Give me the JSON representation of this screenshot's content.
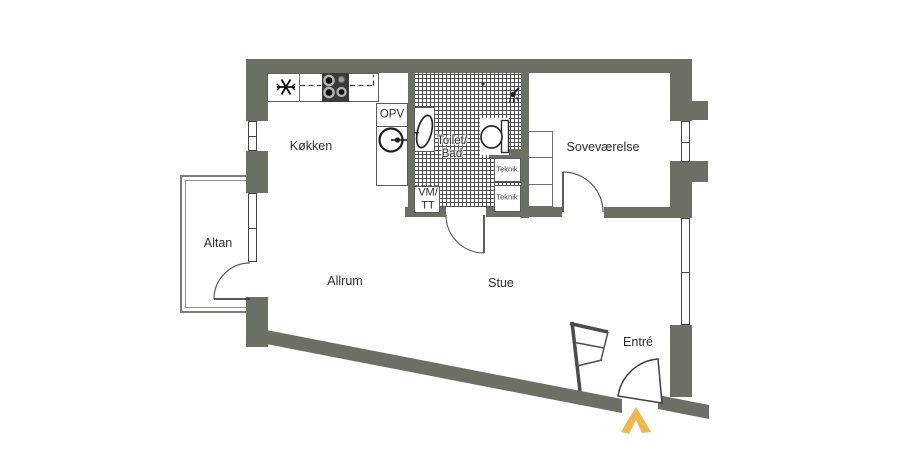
{
  "colors": {
    "wall": "#6b6f64",
    "entrance_arrow": "#f0b64f"
  },
  "rooms": {
    "altan": "Altan",
    "kokken": "Køkken",
    "allrum": "Allrum",
    "stue": "Stue",
    "sovevaerelse": "Soveværelse",
    "entre": "Entré",
    "toilet_bad": {
      "line1": "Toilet/",
      "line2": "Bad"
    }
  },
  "labels": {
    "opv": "OPV",
    "vm_tt": {
      "line1": "VM/",
      "line2": "TT"
    },
    "teknik_upper": "Teknik",
    "teknik_lower": "Teknik"
  }
}
